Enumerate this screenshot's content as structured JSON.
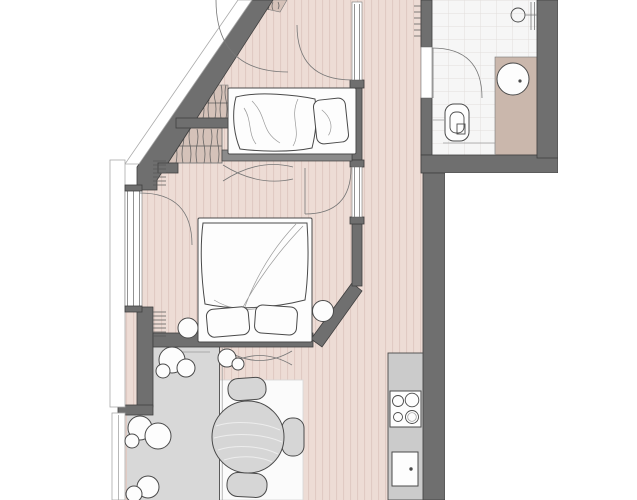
{
  "document": {
    "kind": "architectural-floor-plan",
    "view": "top-down apartment plan",
    "visible_text": [],
    "canvas": {
      "width": 637,
      "height": 500
    }
  },
  "palette": {
    "wall": "#6f6f6f",
    "wall_line": "#3f3f3f",
    "wall_light": "#8b8b8b",
    "paper": "#fdfdfd",
    "line": "#4a4a4a",
    "line_soft": "#777777",
    "hair": "#9a9a9a",
    "trim_line": "#aaaaaa",
    "floor": "#eddcd5",
    "floor_stripe": "#e0cac3",
    "closet": "#d5c2b9",
    "hatch": "#5a5a5a",
    "vanity": "#cab7ac",
    "tile": "#f6f6f6",
    "tile_line": "#e2dedc",
    "terrace": "#d8d8d8",
    "rug": "#fbfbfb",
    "counter": "#cbcbcb",
    "furn_gray": "#d6d6d6"
  },
  "rooms": [
    {
      "id": "bedroom-small",
      "position": "top-left",
      "floor": "wood",
      "items": [
        "single-bed",
        "wardrobe-upper",
        "wardrobe-lower",
        "radiator",
        "window-swing-arcs",
        "sliding-door-symbol"
      ]
    },
    {
      "id": "bedroom-main",
      "position": "middle-left",
      "floor": "wood",
      "items": [
        "double-bed",
        "pillow-left",
        "pillow-right",
        "nightstand-left",
        "nightstand-right",
        "french-window",
        "door-arc",
        "radiator"
      ]
    },
    {
      "id": "hallway",
      "position": "top-center",
      "floor": "wood",
      "items": [
        "radiator-ticks"
      ]
    },
    {
      "id": "bathroom",
      "position": "top-right",
      "floor": "tile",
      "items": [
        "toilet",
        "washbasin-round",
        "vanity-counter",
        "shower-head",
        "glass-partition",
        "door-arc"
      ]
    },
    {
      "id": "living-dining",
      "position": "bottom",
      "floor": "wood",
      "items": [
        "round-table",
        "chair-top",
        "chair-right",
        "chair-bottom",
        "rug",
        "door-symbol-x"
      ]
    },
    {
      "id": "kitchen",
      "position": "bottom-right-strip",
      "floor": "counter",
      "items": [
        "cooktop-4-burners",
        "sink-square"
      ]
    },
    {
      "id": "terrace",
      "position": "bottom-left",
      "floor": "concrete-gray",
      "items": [
        "plant-1",
        "plant-2",
        "plant-3",
        "plant-4",
        "parapet",
        "glass-facade-line"
      ]
    }
  ],
  "symbols": {
    "door_swing": "quarter-circle arc",
    "sliding_double_door": "crossed shallow curves",
    "radiator": "short parallel tick marks",
    "wardrobe": "tan strip with vertical scribble hatching and rail line"
  }
}
